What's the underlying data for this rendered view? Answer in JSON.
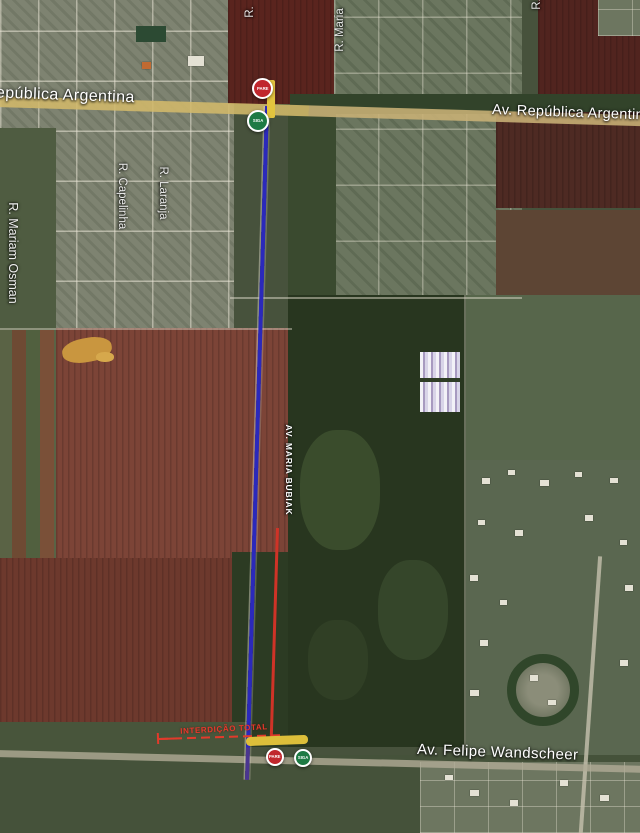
{
  "map": {
    "road_labels": {
      "republica_left": "República Argentina",
      "republica_right": "Av. República Argentina",
      "felipe_wandscheer": "Av. Felipe Wandscheer",
      "maria_bubiak": "AV. MARIA BUBIAK",
      "mariam_osman": "R. Mariam Osman",
      "capelinha": "R. Capelinha",
      "laranja": "R. Laranja",
      "maria": "R. Maria",
      "r_partial_left": "R.",
      "r_partial_right": "R."
    },
    "annotations": {
      "closure_label": "INTERDIÇÃO TOTAL",
      "stop_sign": "PARE",
      "go_sign": "SIGA"
    },
    "colors": {
      "route_line": "#2b29bb",
      "closure": "#e03a2c",
      "road_highlight": "#d2b96a",
      "stop_sign_fill": "#c0272d",
      "go_sign_fill": "#1e7a44"
    }
  }
}
